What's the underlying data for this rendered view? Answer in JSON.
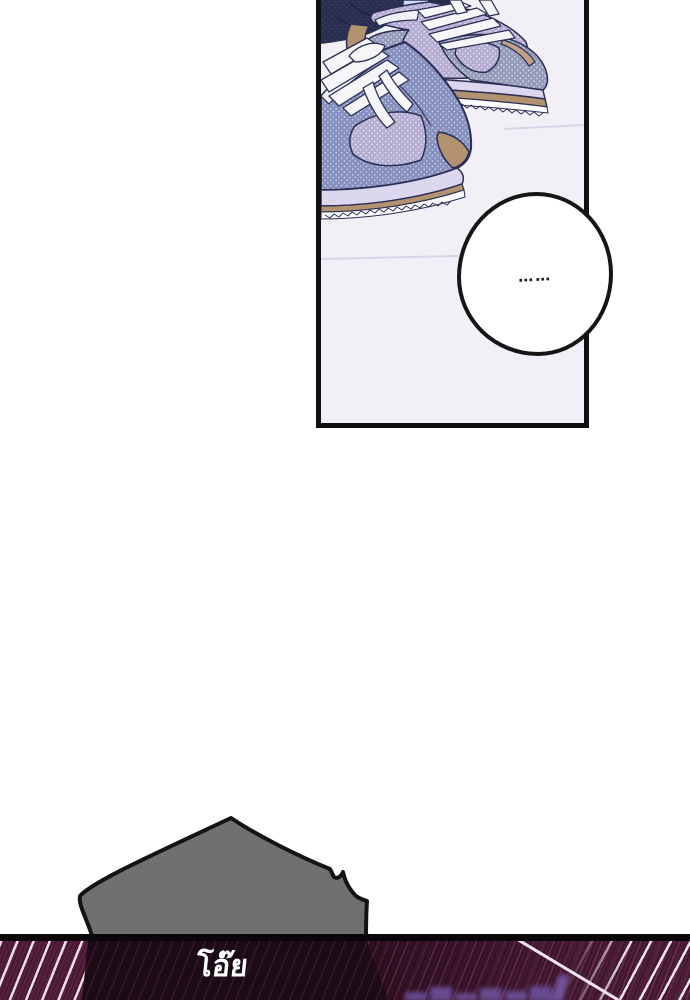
{
  "page": {
    "background_color": "#ffffff"
  },
  "panel": {
    "description": "top-down view of two sneakers standing on a pale floor",
    "border_color": "#101010",
    "floor_color": "#f2eff7",
    "bubble_text": "……",
    "colors": {
      "outline_navy": "#2b2f55",
      "sneaker_lavender": "#b6aed2",
      "sneaker_blue": "#8791be",
      "sneaker_gray": "#959cba",
      "sole_tan": "#b2926f",
      "midsole_lilac": "#dcd7ee",
      "lace_white": "#f5f5fa",
      "pant_navy": "#2a2f52",
      "sock_blue": "#cfdcf1"
    }
  },
  "bottom": {
    "sfx_text": "โอ๊ย",
    "lump_color": "#707070",
    "lump_outline": "#141414",
    "hatch_maroon": "#561f3e",
    "hatch_highlight": "#f1e4ed",
    "shadow_dark": "#1a0b15",
    "glow_purple": "#6b4f96",
    "divider_color": "#0b0609"
  }
}
